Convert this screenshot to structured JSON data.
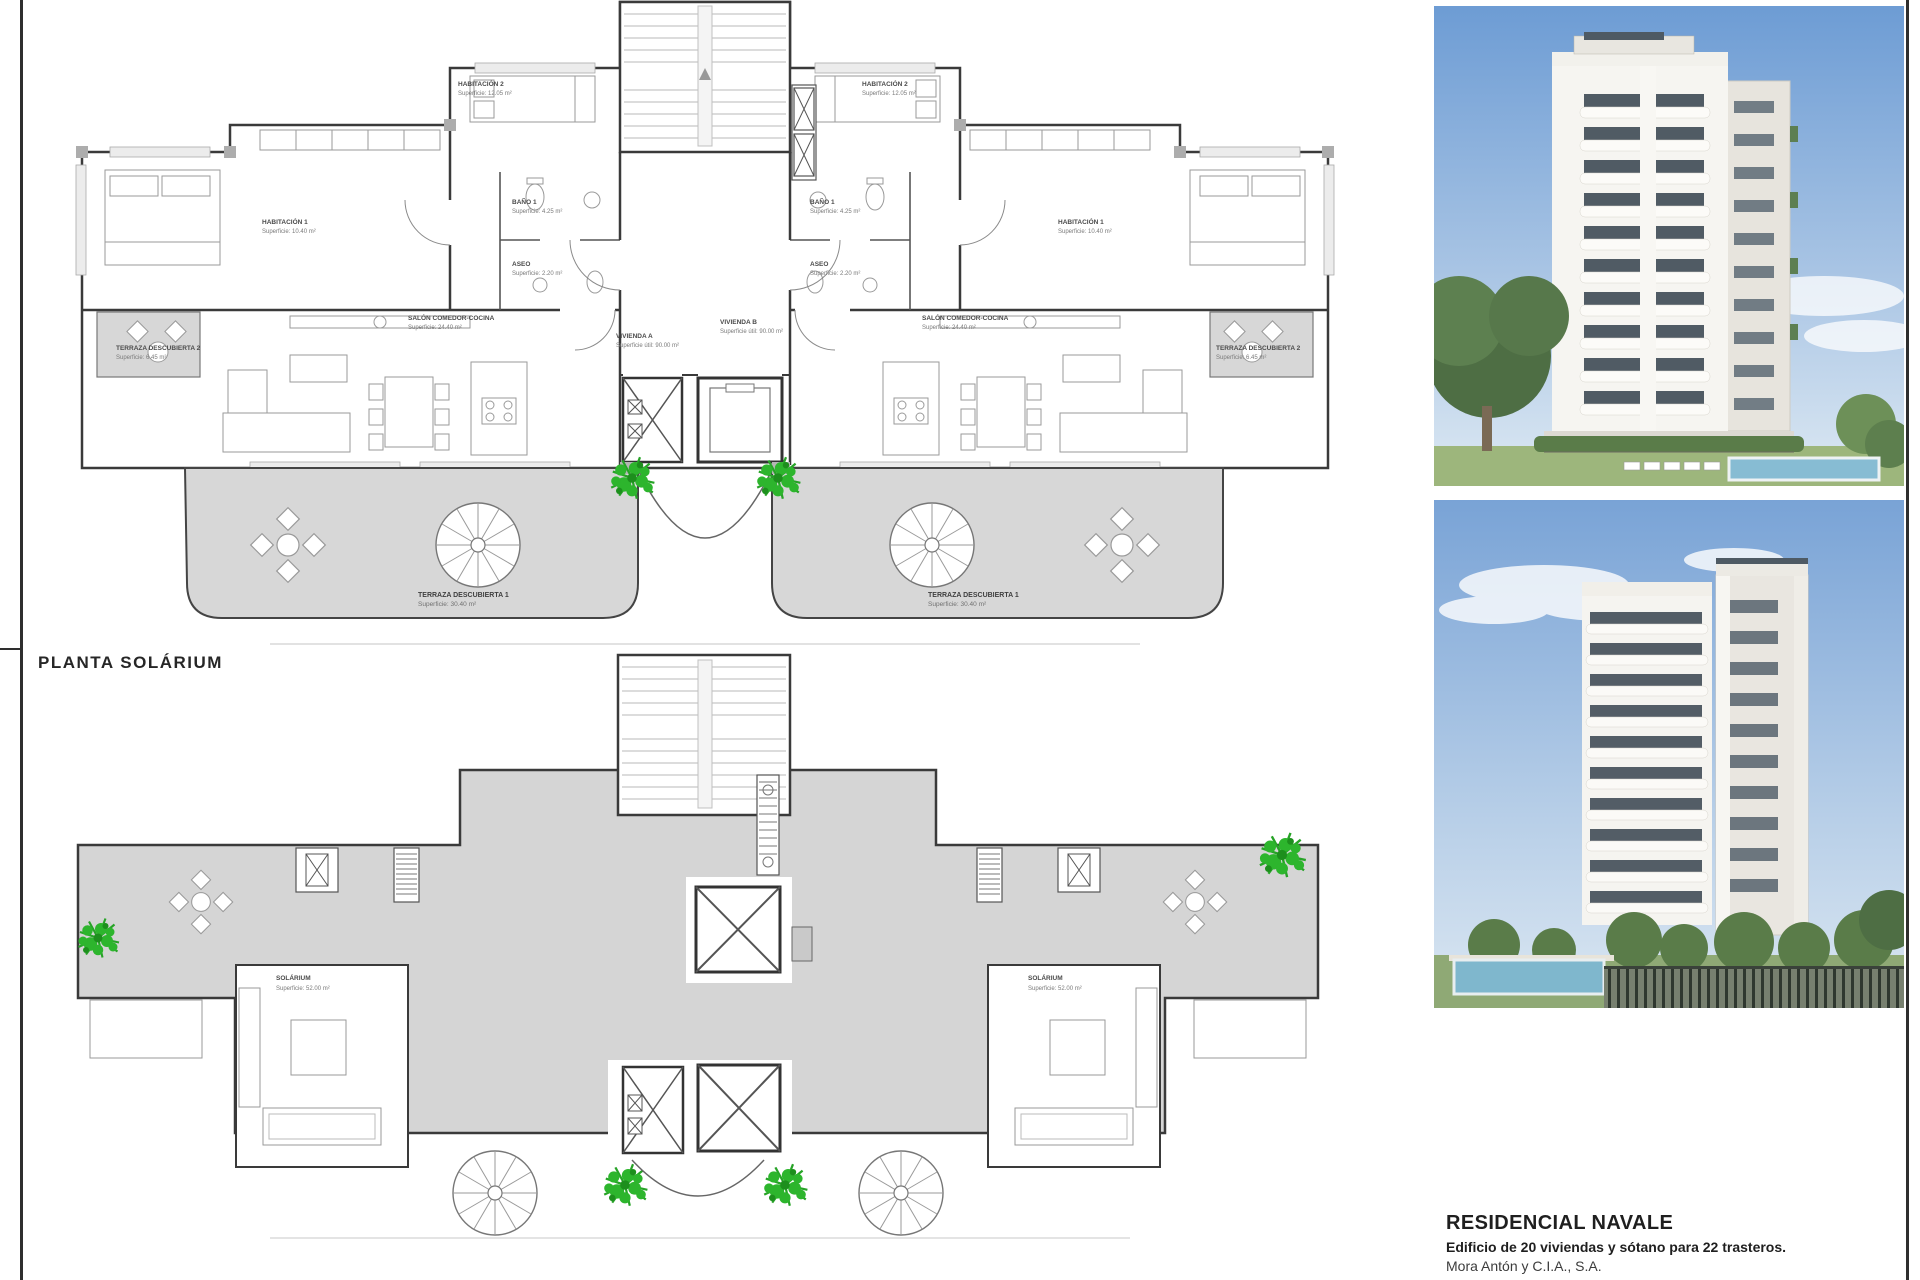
{
  "document": {
    "type": "architectural-plan-sheet",
    "plan_title": "PLANTA SOLÁRIUM"
  },
  "footer": {
    "title": "RESIDENCIAL NAVALE",
    "subtitle": "Edificio de 20 viviendas y sótano para 22 trasteros.",
    "company": "Mora Antón y C.I.A., S.A."
  },
  "top_plan": {
    "labels": {
      "hab1": {
        "l1": "HABITACIÓN 1",
        "l2": "Superficie: 10.40 m²"
      },
      "hab2": {
        "l1": "HABITACIÓN 2",
        "l2": "Superficie: 12.05 m²"
      },
      "bano1": {
        "l1": "BAÑO 1",
        "l2": "Superficie: 4.25 m²"
      },
      "aseo": {
        "l1": "ASEO",
        "l2": "Superficie: 2.20 m²"
      },
      "salon": {
        "l1": "SALÓN COMEDOR-COCINA",
        "l2": "Superficie: 24.40 m²"
      },
      "vivienda_a": {
        "l1": "VIVIENDA A",
        "l2": "Superficie útil: 90.00 m²"
      },
      "vivienda_b": {
        "l1": "VIVIENDA B",
        "l2": "Superficie útil: 90.00 m²"
      },
      "terraza1": {
        "l1": "TERRAZA DESCUBIERTA 1",
        "l2": "Superficie: 30.40 m²"
      },
      "terraza2": {
        "l1": "TERRAZA DESCUBIERTA 2",
        "l2": "Superficie: 6.45 m²"
      }
    }
  },
  "bottom_plan": {
    "labels": {
      "solarium": {
        "l1": "SOLÁRIUM",
        "l2": "Superficie: 52.00 m²"
      }
    }
  },
  "colors": {
    "wall": "#3a3a3a",
    "terrace_gray": "#d6d6d6",
    "plant_green": "#2db52d",
    "sky_blue": "#6d9cd4",
    "frame": "#2e2e2e"
  }
}
